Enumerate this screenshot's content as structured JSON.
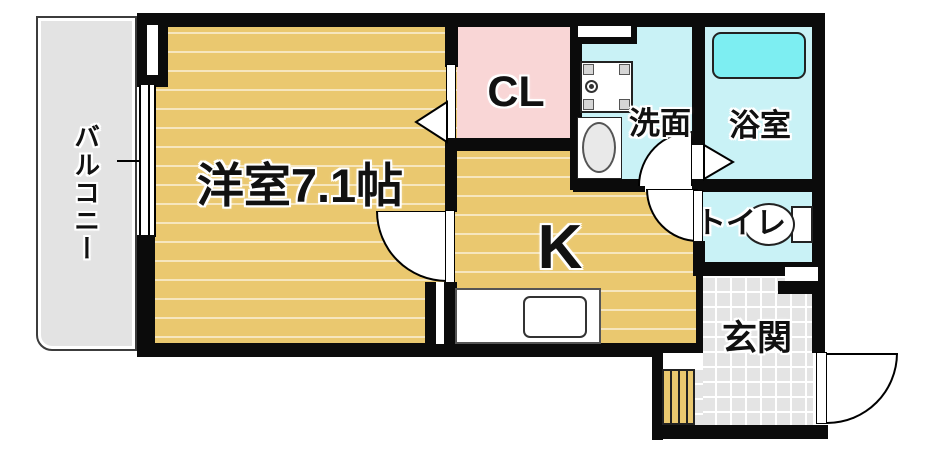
{
  "rooms": {
    "balcony": {
      "label": "バルコニー"
    },
    "western_room": {
      "label": "洋室7.1帖",
      "size_note": "7.1帖"
    },
    "closet": {
      "label": "CL"
    },
    "kitchen": {
      "label": "K"
    },
    "washroom": {
      "label": "洗面"
    },
    "bathroom": {
      "label": "浴室"
    },
    "toilet": {
      "label": "トイレ"
    },
    "entrance": {
      "label": "玄関"
    }
  },
  "colors": {
    "wall": "#0b0b0b",
    "wood": "#eac86f",
    "wood_stripe": "rgba(255,255,255,0.55)",
    "pink": "#f9d6d6",
    "cyan": "#c9f2f6",
    "tub": "#7deef2",
    "tile": "#e4e4e4",
    "tile_line": "#ffffff",
    "balcony": "#e3e3e3",
    "text": "#111111"
  },
  "icons": {
    "bathtub-icon": "rounded-rect",
    "washing-machine-pan-icon": "square-with-corner-pads-and-drain",
    "sink-basin-icon": "oval",
    "toilet-icon": "bowl-and-tank",
    "kitchen-sink-icon": "rounded-rect",
    "shoe-cabinet-icon": "striped-box",
    "door-swing-icon": "quarter-circle",
    "folding-door-icon": "triangle",
    "window-icon": "double-line"
  }
}
